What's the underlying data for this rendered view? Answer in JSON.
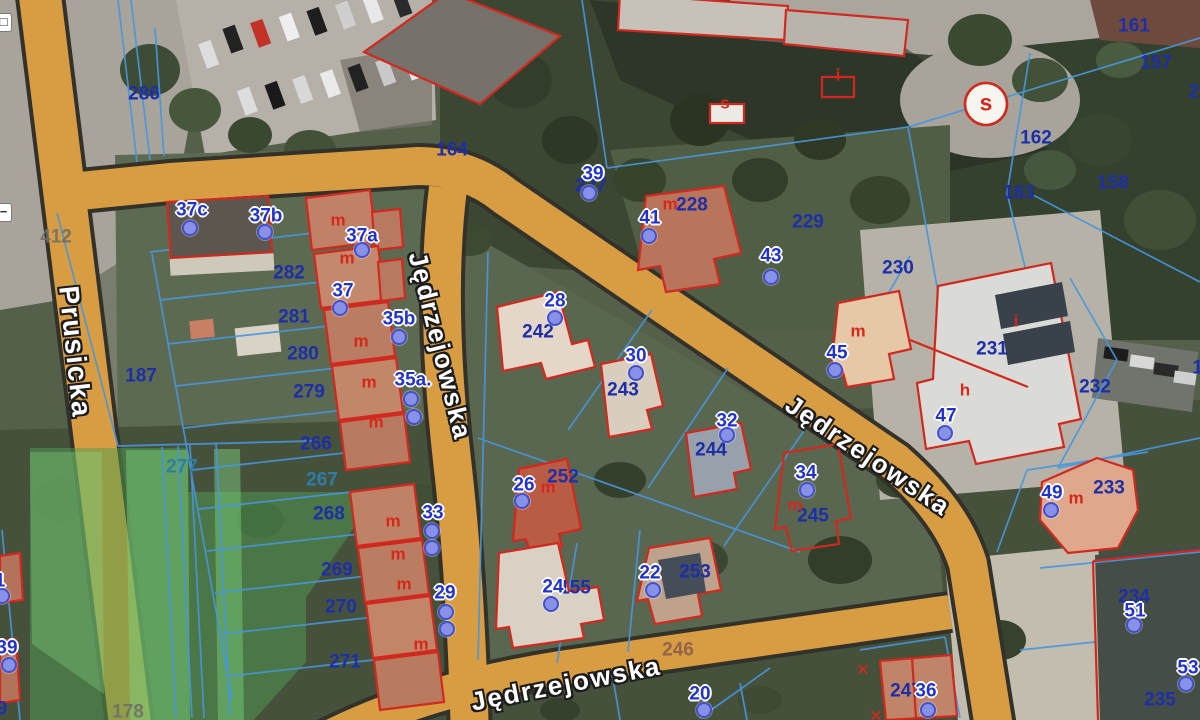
{
  "streets": {
    "prusicka": "Prusicka",
    "jedrzejowska": "Jędrzejowska"
  },
  "map": {
    "labels": [
      {
        "type": "p",
        "text": "286",
        "x": 144,
        "y": 94
      },
      {
        "type": "p",
        "text": "164",
        "x": 452,
        "y": 150
      },
      {
        "type": "p",
        "text": "282",
        "x": 289,
        "y": 273
      },
      {
        "type": "p",
        "text": "281",
        "x": 294,
        "y": 317
      },
      {
        "type": "p",
        "text": "280",
        "x": 303,
        "y": 354
      },
      {
        "type": "p",
        "text": "279",
        "x": 309,
        "y": 392
      },
      {
        "type": "p",
        "text": "187",
        "x": 141,
        "y": 376
      },
      {
        "type": "p",
        "text": "266",
        "x": 316,
        "y": 444
      },
      {
        "type": "p",
        "text": "268",
        "x": 329,
        "y": 514
      },
      {
        "type": "p",
        "text": "269",
        "x": 337,
        "y": 570
      },
      {
        "type": "p",
        "text": "270",
        "x": 341,
        "y": 607
      },
      {
        "type": "p",
        "text": "271",
        "x": 345,
        "y": 662
      },
      {
        "type": "p",
        "text": "242",
        "x": 538,
        "y": 332
      },
      {
        "type": "p",
        "text": "243",
        "x": 623,
        "y": 390
      },
      {
        "type": "p",
        "text": "244",
        "x": 711,
        "y": 450
      },
      {
        "type": "p",
        "text": "252",
        "x": 563,
        "y": 477
      },
      {
        "type": "p",
        "text": "155",
        "x": 575,
        "y": 588
      },
      {
        "type": "p",
        "text": "253",
        "x": 695,
        "y": 572
      },
      {
        "type": "p",
        "text": "227",
        "x": 591,
        "y": 186
      },
      {
        "type": "p",
        "text": "228",
        "x": 692,
        "y": 205
      },
      {
        "type": "p",
        "text": "229",
        "x": 808,
        "y": 222
      },
      {
        "type": "p",
        "text": "230",
        "x": 898,
        "y": 268
      },
      {
        "type": "p",
        "text": "231",
        "x": 992,
        "y": 349
      },
      {
        "type": "p",
        "text": "232",
        "x": 1095,
        "y": 387
      },
      {
        "type": "p",
        "text": "233",
        "x": 1109,
        "y": 488
      },
      {
        "type": "p",
        "text": "234",
        "x": 1134,
        "y": 597
      },
      {
        "type": "p",
        "text": "235",
        "x": 1160,
        "y": 700
      },
      {
        "type": "p",
        "text": "245",
        "x": 813,
        "y": 516
      },
      {
        "type": "p",
        "text": "247",
        "x": 906,
        "y": 691
      },
      {
        "type": "p",
        "text": "161",
        "x": 1134,
        "y": 26
      },
      {
        "type": "p",
        "text": "157",
        "x": 1156,
        "y": 63
      },
      {
        "type": "p",
        "text": "158",
        "x": 1113,
        "y": 183
      },
      {
        "type": "p",
        "text": "162",
        "x": 1036,
        "y": 138
      },
      {
        "type": "p",
        "text": "163",
        "x": 1019,
        "y": 193
      },
      {
        "type": "p",
        "text": "29",
        "x": 1199,
        "y": 92
      },
      {
        "type": "p",
        "text": "15",
        "x": 1203,
        "y": 368
      },
      {
        "type": "p",
        "text": "9",
        "x": 2,
        "y": 709
      },
      {
        "type": "pt",
        "text": "277",
        "x": 182,
        "y": 467
      },
      {
        "type": "pt",
        "text": "267",
        "x": 322,
        "y": 480
      },
      {
        "type": "pg",
        "text": "412",
        "x": 56,
        "y": 237
      },
      {
        "type": "pg",
        "text": "178",
        "x": 128,
        "y": 712
      },
      {
        "type": "pd",
        "text": "246",
        "x": 678,
        "y": 650
      },
      {
        "type": "a",
        "text": "37c",
        "x": 192,
        "y": 210
      },
      {
        "type": "a",
        "text": "37b",
        "x": 266,
        "y": 216
      },
      {
        "type": "a",
        "text": "37a",
        "x": 362,
        "y": 236
      },
      {
        "type": "a",
        "text": "37",
        "x": 343,
        "y": 291
      },
      {
        "type": "a",
        "text": "35b",
        "x": 399,
        "y": 319
      },
      {
        "type": "a",
        "text": "35a.",
        "x": 413,
        "y": 380
      },
      {
        "type": "a",
        "text": "33",
        "x": 433,
        "y": 513
      },
      {
        "type": "a",
        "text": "29",
        "x": 445,
        "y": 593
      },
      {
        "type": "a",
        "text": "39",
        "x": 593,
        "y": 174
      },
      {
        "type": "a",
        "text": "41",
        "x": 650,
        "y": 218
      },
      {
        "type": "a",
        "text": "43",
        "x": 771,
        "y": 256
      },
      {
        "type": "a",
        "text": "28",
        "x": 555,
        "y": 301
      },
      {
        "type": "a",
        "text": "30",
        "x": 636,
        "y": 356
      },
      {
        "type": "a",
        "text": "32",
        "x": 727,
        "y": 421
      },
      {
        "type": "a",
        "text": "26",
        "x": 524,
        "y": 485
      },
      {
        "type": "a",
        "text": "24",
        "x": 553,
        "y": 587
      },
      {
        "type": "a",
        "text": "22",
        "x": 650,
        "y": 573
      },
      {
        "type": "a",
        "text": "34",
        "x": 806,
        "y": 473
      },
      {
        "type": "a",
        "text": "45",
        "x": 837,
        "y": 353
      },
      {
        "type": "a",
        "text": "47",
        "x": 946,
        "y": 416
      },
      {
        "type": "a",
        "text": "49",
        "x": 1052,
        "y": 493
      },
      {
        "type": "a",
        "text": "51",
        "x": 1135,
        "y": 611
      },
      {
        "type": "a",
        "text": "53",
        "x": 1188,
        "y": 668
      },
      {
        "type": "a",
        "text": "36",
        "x": 926,
        "y": 691
      },
      {
        "type": "a",
        "text": "20",
        "x": 700,
        "y": 694
      },
      {
        "type": "a",
        "text": "39",
        "x": 7,
        "y": 648
      },
      {
        "type": "a",
        "text": "1",
        "x": 0,
        "y": 581
      },
      {
        "type": "r",
        "text": "m",
        "x": 338,
        "y": 220
      },
      {
        "type": "r",
        "text": "m",
        "x": 347,
        "y": 258
      },
      {
        "type": "r",
        "text": "m",
        "x": 361,
        "y": 341
      },
      {
        "type": "r",
        "text": "m",
        "x": 369,
        "y": 382
      },
      {
        "type": "r",
        "text": "m",
        "x": 376,
        "y": 422
      },
      {
        "type": "r",
        "text": "m",
        "x": 393,
        "y": 521
      },
      {
        "type": "r",
        "text": "m",
        "x": 398,
        "y": 554
      },
      {
        "type": "r",
        "text": "m",
        "x": 404,
        "y": 584
      },
      {
        "type": "r",
        "text": "m",
        "x": 421,
        "y": 644
      },
      {
        "type": "r",
        "text": "m",
        "x": 670,
        "y": 204
      },
      {
        "type": "r",
        "text": "m",
        "x": 548,
        "y": 487
      },
      {
        "type": "r",
        "text": "m",
        "x": 858,
        "y": 331
      },
      {
        "type": "r",
        "text": "m",
        "x": 795,
        "y": 505
      },
      {
        "type": "r",
        "text": "m",
        "x": 1076,
        "y": 498
      },
      {
        "type": "r",
        "text": "h",
        "x": 965,
        "y": 390
      },
      {
        "type": "r",
        "text": "i",
        "x": 1016,
        "y": 321
      },
      {
        "type": "r",
        "text": "s",
        "x": 725,
        "y": 103
      },
      {
        "type": "r",
        "text": "i",
        "x": 838,
        "y": 75
      },
      {
        "type": "r",
        "text": "✕",
        "x": 863,
        "y": 670
      },
      {
        "type": "r",
        "text": "✕",
        "x": 876,
        "y": 716
      },
      {
        "type": "rs",
        "text": "s",
        "x": 986,
        "y": 103
      }
    ],
    "points": [
      {
        "x": 190,
        "y": 228
      },
      {
        "x": 265,
        "y": 232
      },
      {
        "x": 362,
        "y": 250
      },
      {
        "x": 340,
        "y": 308
      },
      {
        "x": 399,
        "y": 337
      },
      {
        "x": 411,
        "y": 399
      },
      {
        "x": 414,
        "y": 417
      },
      {
        "x": 432,
        "y": 531
      },
      {
        "x": 432,
        "y": 548
      },
      {
        "x": 446,
        "y": 612
      },
      {
        "x": 447,
        "y": 629
      },
      {
        "x": 589,
        "y": 193
      },
      {
        "x": 649,
        "y": 236
      },
      {
        "x": 771,
        "y": 277
      },
      {
        "x": 555,
        "y": 318
      },
      {
        "x": 636,
        "y": 373
      },
      {
        "x": 727,
        "y": 435
      },
      {
        "x": 522,
        "y": 501
      },
      {
        "x": 551,
        "y": 604
      },
      {
        "x": 653,
        "y": 590
      },
      {
        "x": 807,
        "y": 490
      },
      {
        "x": 835,
        "y": 370
      },
      {
        "x": 945,
        "y": 433
      },
      {
        "x": 1051,
        "y": 510
      },
      {
        "x": 1134,
        "y": 625
      },
      {
        "x": 1186,
        "y": 684
      },
      {
        "x": 928,
        "y": 710
      },
      {
        "x": 704,
        "y": 710
      },
      {
        "x": 9,
        "y": 665
      },
      {
        "x": 2,
        "y": 596
      }
    ],
    "controls": [
      {
        "glyph": "□",
        "y": 13
      },
      {
        "glyph": "−",
        "y": 203
      }
    ],
    "colors": {
      "road": "#d89c42",
      "parcel_line": "#4796dd",
      "building_outline": "#d2281e",
      "parcel_text": "#1d2fa8",
      "address_text": "#2133cc",
      "green_overlay": "#4e9e4e"
    }
  }
}
